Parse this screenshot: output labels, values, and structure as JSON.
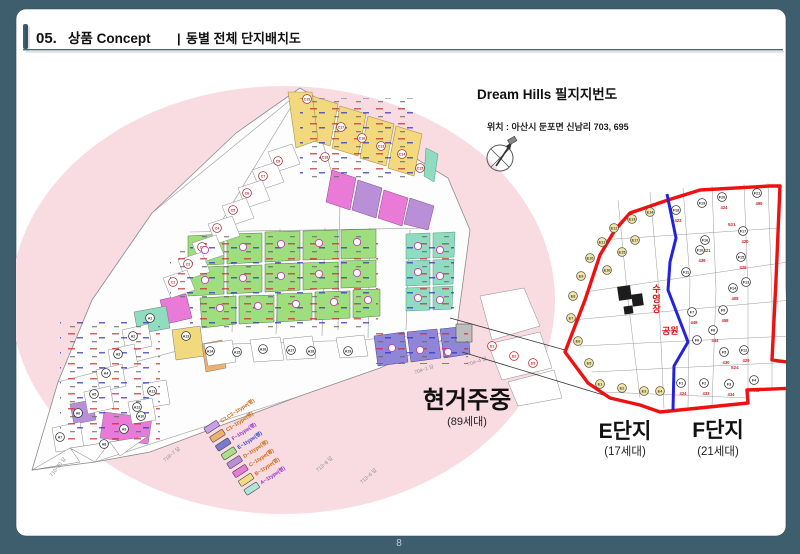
{
  "slide": {
    "frame_color": "#3f5e6d",
    "page_number": "8",
    "header": {
      "number": "05.",
      "title": "상품 Concept",
      "separator": "|",
      "subtitle": "동별 전체 단지배치도"
    }
  },
  "map_title": "Dream Hills 필지지번도",
  "location_line": "위치 : 아산시 둔포면 신남리 703, 695",
  "status": {
    "label": "현거주중",
    "count": "(89세대)"
  },
  "complex_e": {
    "label": "E단지",
    "count": "(17세대)"
  },
  "complex_f": {
    "label": "F단지",
    "count": "(21세대)"
  },
  "legend": {
    "items": [
      {
        "label": "A~1type(평)",
        "color": "#aee6d8",
        "text_color": "#8a33cc"
      },
      {
        "label": "B~1type(평)",
        "color": "#f2dc82",
        "text_color": "#cc6611"
      },
      {
        "label": "C~1type(평)",
        "color": "#ea7ad8",
        "text_color": "#cc6611"
      },
      {
        "label": "D~1type(평)",
        "color": "#b98fd8",
        "text_color": "#cc6611"
      },
      {
        "label": "E~1type(평)",
        "color": "#a8e08a",
        "text_color": "#2a44cc"
      },
      {
        "label": "F~1type(평)",
        "color": "#7a7ad0",
        "text_color": "#8a33cc"
      },
      {
        "label": "C1~1type(평)",
        "color": "#f0b070",
        "text_color": "#cc6611"
      },
      {
        "label": "C2,C3~1type(평)",
        "color": "#c9a0e8",
        "text_color": "#cc6611"
      }
    ]
  },
  "left_map": {
    "series_colors": {
      "c": "#a33333",
      "a": "#333333",
      "d": "#cc2222"
    },
    "markers": [
      {
        "t": "C19",
        "x": 307,
        "y": 99,
        "s": "c"
      },
      {
        "t": "C17",
        "x": 341,
        "y": 127,
        "s": "c"
      },
      {
        "t": "C16",
        "x": 362,
        "y": 138,
        "s": "c"
      },
      {
        "t": "C13",
        "x": 381,
        "y": 146,
        "s": "c"
      },
      {
        "t": "C14",
        "x": 402,
        "y": 154,
        "s": "c"
      },
      {
        "t": "C18",
        "x": 325,
        "y": 157,
        "s": "c"
      },
      {
        "t": "C15",
        "x": 420,
        "y": 168,
        "s": "c"
      },
      {
        "t": "C8",
        "x": 278,
        "y": 161,
        "s": "c"
      },
      {
        "t": "C7",
        "x": 263,
        "y": 176,
        "s": "c"
      },
      {
        "t": "C6",
        "x": 247,
        "y": 193,
        "s": "c"
      },
      {
        "t": "C5",
        "x": 233,
        "y": 210,
        "s": "c"
      },
      {
        "t": "C4",
        "x": 217,
        "y": 228,
        "s": "c"
      },
      {
        "t": "C3",
        "x": 202,
        "y": 247,
        "s": "c"
      },
      {
        "t": "C2",
        "x": 188,
        "y": 264,
        "s": "c"
      },
      {
        "t": "C1",
        "x": 173,
        "y": 282,
        "s": "c"
      },
      {
        "t": "A1",
        "x": 150,
        "y": 318,
        "s": "a"
      },
      {
        "t": "A2",
        "x": 133,
        "y": 336,
        "s": "a"
      },
      {
        "t": "A3",
        "x": 118,
        "y": 354,
        "s": "a"
      },
      {
        "t": "A4",
        "x": 106,
        "y": 373,
        "s": "a"
      },
      {
        "t": "A5",
        "x": 94,
        "y": 394,
        "s": "a"
      },
      {
        "t": "A6",
        "x": 78,
        "y": 413,
        "s": "a"
      },
      {
        "t": "A7",
        "x": 60,
        "y": 437,
        "s": "a"
      },
      {
        "t": "A8",
        "x": 104,
        "y": 444,
        "s": "a"
      },
      {
        "t": "A9",
        "x": 124,
        "y": 429,
        "s": "a"
      },
      {
        "t": "A10",
        "x": 141,
        "y": 416,
        "s": "a"
      },
      {
        "t": "A11",
        "x": 152,
        "y": 391,
        "s": "a"
      },
      {
        "t": "A12",
        "x": 137,
        "y": 407,
        "s": "a"
      },
      {
        "t": "A13",
        "x": 186,
        "y": 336,
        "s": "a"
      },
      {
        "t": "A14",
        "x": 210,
        "y": 351,
        "s": "a"
      },
      {
        "t": "A15",
        "x": 237,
        "y": 352,
        "s": "a"
      },
      {
        "t": "A16",
        "x": 263,
        "y": 349,
        "s": "a"
      },
      {
        "t": "A17",
        "x": 291,
        "y": 350,
        "s": "a"
      },
      {
        "t": "A18",
        "x": 311,
        "y": 351,
        "s": "a"
      },
      {
        "t": "A19",
        "x": 348,
        "y": 351,
        "s": "a"
      },
      {
        "t": "D1",
        "x": 492,
        "y": 346,
        "s": "d"
      },
      {
        "t": "D2",
        "x": 514,
        "y": 356,
        "s": "d"
      },
      {
        "t": "D3",
        "x": 533,
        "y": 363,
        "s": "d"
      }
    ],
    "b_dots": [
      {
        "x": 205,
        "y": 250
      },
      {
        "x": 243,
        "y": 247
      },
      {
        "x": 281,
        "y": 244
      },
      {
        "x": 319,
        "y": 243
      },
      {
        "x": 357,
        "y": 242
      },
      {
        "x": 205,
        "y": 280
      },
      {
        "x": 243,
        "y": 278
      },
      {
        "x": 281,
        "y": 276
      },
      {
        "x": 319,
        "y": 274
      },
      {
        "x": 357,
        "y": 273
      },
      {
        "x": 220,
        "y": 308
      },
      {
        "x": 258,
        "y": 306
      },
      {
        "x": 296,
        "y": 304
      },
      {
        "x": 334,
        "y": 302
      },
      {
        "x": 368,
        "y": 300
      },
      {
        "x": 418,
        "y": 246
      },
      {
        "x": 418,
        "y": 272
      },
      {
        "x": 418,
        "y": 298
      },
      {
        "x": 440,
        "y": 250
      },
      {
        "x": 440,
        "y": 276
      },
      {
        "x": 440,
        "y": 300
      },
      {
        "x": 392,
        "y": 348
      },
      {
        "x": 420,
        "y": 350
      },
      {
        "x": 448,
        "y": 352
      }
    ],
    "road_labels": [
      {
        "t": "710~20 답",
        "x": 52,
        "y": 477,
        "r": -52
      },
      {
        "t": "718~7 답",
        "x": 165,
        "y": 462,
        "r": -40
      },
      {
        "t": "713~8 답",
        "x": 318,
        "y": 472,
        "r": -42
      },
      {
        "t": "713~6 답",
        "x": 362,
        "y": 484,
        "r": -42
      },
      {
        "t": "704~1 답",
        "x": 415,
        "y": 374,
        "r": -18
      },
      {
        "t": "704~4 답",
        "x": 468,
        "y": 366,
        "r": -18
      }
    ]
  },
  "right_map": {
    "pool_label": "수영장",
    "park_label": "공원",
    "road_labels": [
      {
        "t": "521",
        "x": 728,
        "y": 226
      },
      {
        "t": "524",
        "x": 731,
        "y": 369
      }
    ],
    "e_parcels": [
      {
        "t": "E1",
        "x": 600,
        "y": 384
      },
      {
        "t": "E2",
        "x": 622,
        "y": 388
      },
      {
        "t": "E3",
        "x": 644,
        "y": 391
      },
      {
        "t": "E4",
        "x": 660,
        "y": 391
      },
      {
        "t": "E5",
        "x": 589,
        "y": 363
      },
      {
        "t": "E6",
        "x": 578,
        "y": 341
      },
      {
        "t": "E7",
        "x": 571,
        "y": 318
      },
      {
        "t": "E8",
        "x": 573,
        "y": 296
      },
      {
        "t": "E9",
        "x": 581,
        "y": 276
      },
      {
        "t": "E10",
        "x": 590,
        "y": 258
      },
      {
        "t": "E11",
        "x": 602,
        "y": 242
      },
      {
        "t": "E12",
        "x": 614,
        "y": 228
      },
      {
        "t": "E13",
        "x": 632,
        "y": 219
      },
      {
        "t": "E14",
        "x": 650,
        "y": 212
      },
      {
        "t": "E15",
        "x": 622,
        "y": 252
      },
      {
        "t": "E16",
        "x": 607,
        "y": 270
      },
      {
        "t": "E17",
        "x": 635,
        "y": 240
      }
    ],
    "f_parcels": [
      {
        "t": "F1",
        "x": 681,
        "y": 383,
        "n": "424"
      },
      {
        "t": "F2",
        "x": 704,
        "y": 383,
        "n": "433"
      },
      {
        "t": "F3",
        "x": 729,
        "y": 384,
        "n": "434"
      },
      {
        "t": "F4",
        "x": 754,
        "y": 380,
        "n": "448"
      },
      {
        "t": "F5",
        "x": 724,
        "y": 352,
        "n": "430"
      },
      {
        "t": "F6",
        "x": 697,
        "y": 340,
        "n": ""
      },
      {
        "t": "F7",
        "x": 692,
        "y": 312,
        "n": "449"
      },
      {
        "t": "F8",
        "x": 713,
        "y": 330,
        "n": "444"
      },
      {
        "t": "F9",
        "x": 723,
        "y": 310,
        "n": "458"
      },
      {
        "t": "F10",
        "x": 700,
        "y": 250,
        "n": "439"
      },
      {
        "t": "F11",
        "x": 686,
        "y": 272,
        "n": ""
      },
      {
        "t": "F12",
        "x": 744,
        "y": 350,
        "n": "429"
      },
      {
        "t": "F13",
        "x": 746,
        "y": 282,
        "n": ""
      },
      {
        "t": "F14",
        "x": 733,
        "y": 288,
        "n": "408"
      },
      {
        "t": "F15",
        "x": 741,
        "y": 257,
        "n": "429"
      },
      {
        "t": "F16",
        "x": 705,
        "y": 240,
        "n": "421"
      },
      {
        "t": "F17",
        "x": 743,
        "y": 231,
        "n": "420"
      },
      {
        "t": "F18",
        "x": 676,
        "y": 210,
        "n": "423"
      },
      {
        "t": "F19",
        "x": 702,
        "y": 203,
        "n": ""
      },
      {
        "t": "F20",
        "x": 722,
        "y": 197,
        "n": "424"
      },
      {
        "t": "F21",
        "x": 757,
        "y": 193,
        "n": "499"
      }
    ]
  }
}
